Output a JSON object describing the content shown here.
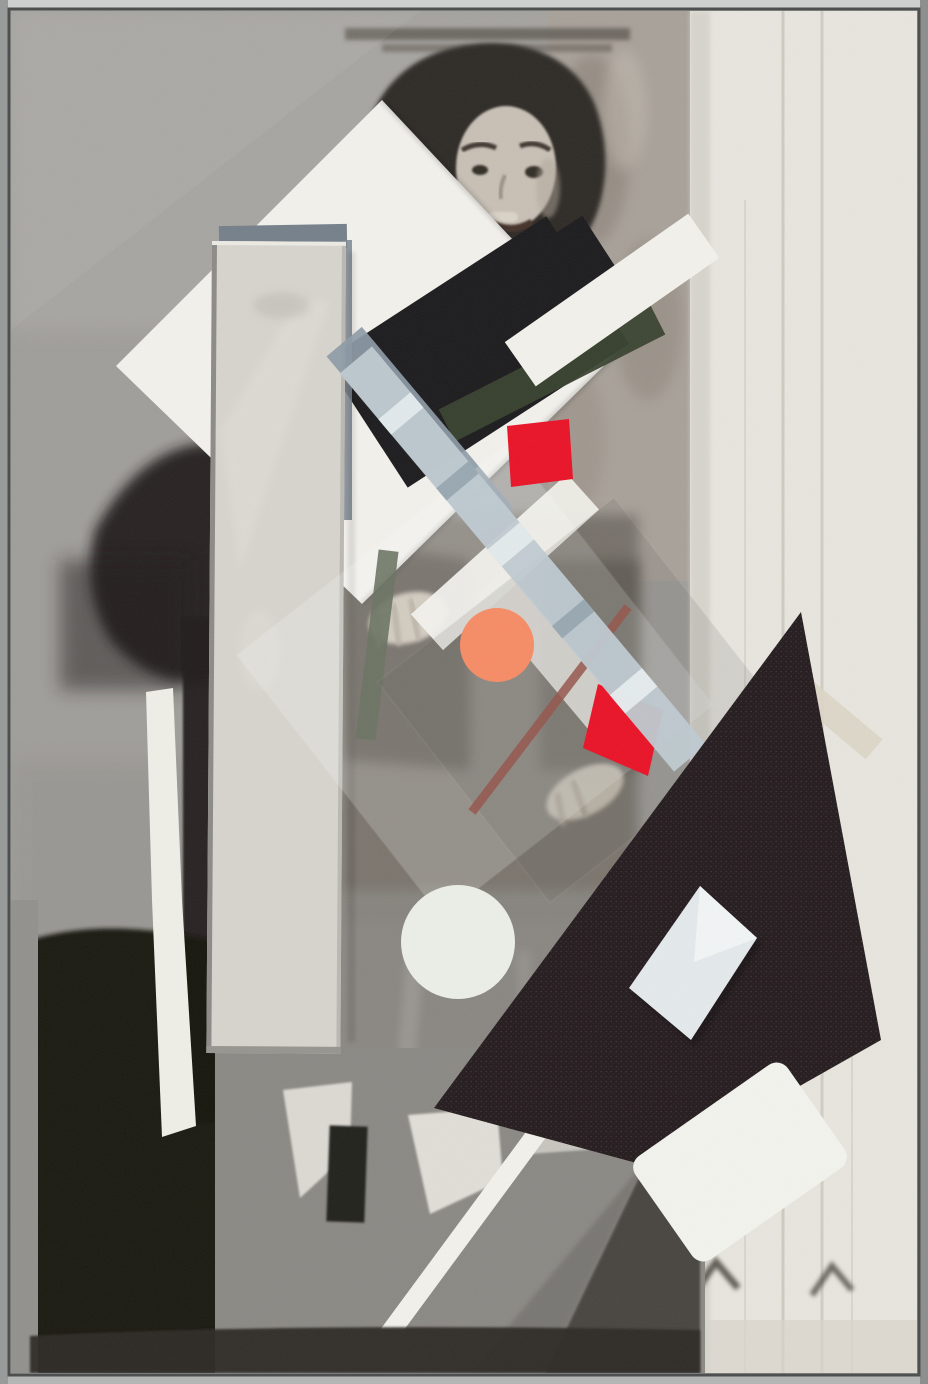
{
  "artwork": {
    "kind": "framed mixed-media constructivist collage mounted over a halftone black-and-white photograph",
    "subject": "smiling dark-haired woman behind overlaid geometric shapes: white diamond, mirror strip, black rectangle, metallic ribbons, red quadrilaterals, orange circle, flocked black triangle with silver foil insert",
    "visible_text": ""
  },
  "colors": {
    "frame": "#a7a9a8",
    "frame_highlight": "#cdcfce",
    "frame_shadow": "#4e504f",
    "wall": "#a09e9a",
    "wall_light": "#adaba7",
    "curtain": "#e7e5de",
    "curtain_seam": "#c8c4b9",
    "plaster": "#a8a199",
    "plaster_dark": "#857d72",
    "hair": "#2e2a25",
    "skin": "#c8c0b5",
    "photo_shadow": "#221f1b",
    "photo_black": "#16130f",
    "photo_mid_gray": "#8b8984",
    "torso_gray": "#746e66",
    "skirt_gray": "#898681",
    "white_diamond": "#f2f1ec",
    "mirror": "#d6d4cd",
    "mirror_backing": "#75808a",
    "black_rectangle": "#1c1b1d",
    "olive_strip": "#39422f",
    "olive_strip2": "#46513c",
    "slate_ribbon": "#8d9aa6",
    "silver_ribbon": "#bfcad1",
    "silver_highlight": "#e9eef1",
    "silver_shadow": "#90a0aa",
    "white_strip": "#f2f1eb",
    "red": "#ea1327",
    "orange_circle": "#f68c66",
    "rust_line": "#95564c",
    "flock_triangle": "#231b1d",
    "foil": "#e4e9eb",
    "white_circle": "#eceee8",
    "white_card": "#f3f3ee",
    "torn_strip": "#efeee7",
    "beige_strip": "#dcd5c7",
    "lamp_light": "#e0ded7",
    "dark_bar": "#24221d",
    "bottom_band": "#2d2b28",
    "wedge_dark": "#45423e",
    "chevron": "#4b463f"
  },
  "elements": [
    "picture-frame",
    "wall-background",
    "curtain-panel",
    "plaster-texture",
    "woman-portrait",
    "white-diamond",
    "mirror-strip",
    "black-rectangle",
    "olive-strip",
    "slate-ribbon",
    "silver-ribbon",
    "white-strips",
    "red-parallelogram",
    "red-diamond",
    "orange-circle",
    "rust-line",
    "vellum-sheet",
    "glitter-sheet",
    "flocked-triangle",
    "foil-parallelogram",
    "white-circle",
    "white-card",
    "torn-paper-strip",
    "lamp-shapes",
    "white-diagonal-stripe",
    "chevron-marks"
  ]
}
